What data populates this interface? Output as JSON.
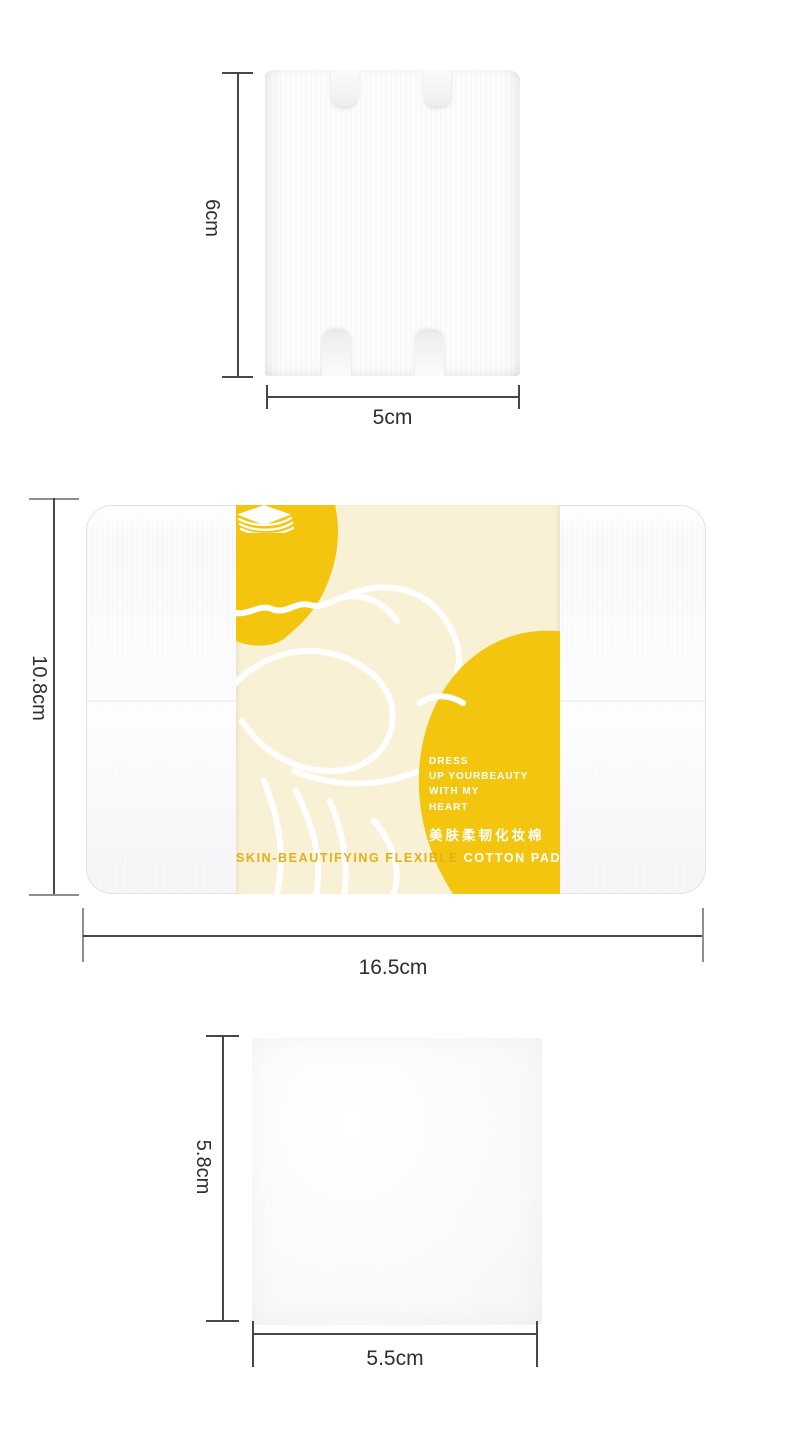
{
  "colors": {
    "yellow": "#F3C50F",
    "cream": "#F8F1D5",
    "gold": "#E3B017",
    "line": "#474747",
    "tick": "#8F8F8F",
    "label": "#2E2E2E"
  },
  "dimensions": {
    "top_pad": {
      "height": "6cm",
      "width": "5cm"
    },
    "package": {
      "height": "10.8cm",
      "width": "16.5cm"
    },
    "bottom_pad": {
      "height": "5.8cm",
      "width": "5.5cm"
    }
  },
  "band": {
    "slogan_lines": [
      "DRESS",
      "UP YOURBEAUTY",
      "WITH MY",
      "HEART"
    ],
    "product_name_cn": "美肤柔韧化妆棉",
    "product_name_en_gold": "SKIN-BEAUTIFYING FLEXIBLE",
    "product_name_en_white": "COTTON PAD",
    "pad_icon": "cotton-pad-stack-icon"
  }
}
